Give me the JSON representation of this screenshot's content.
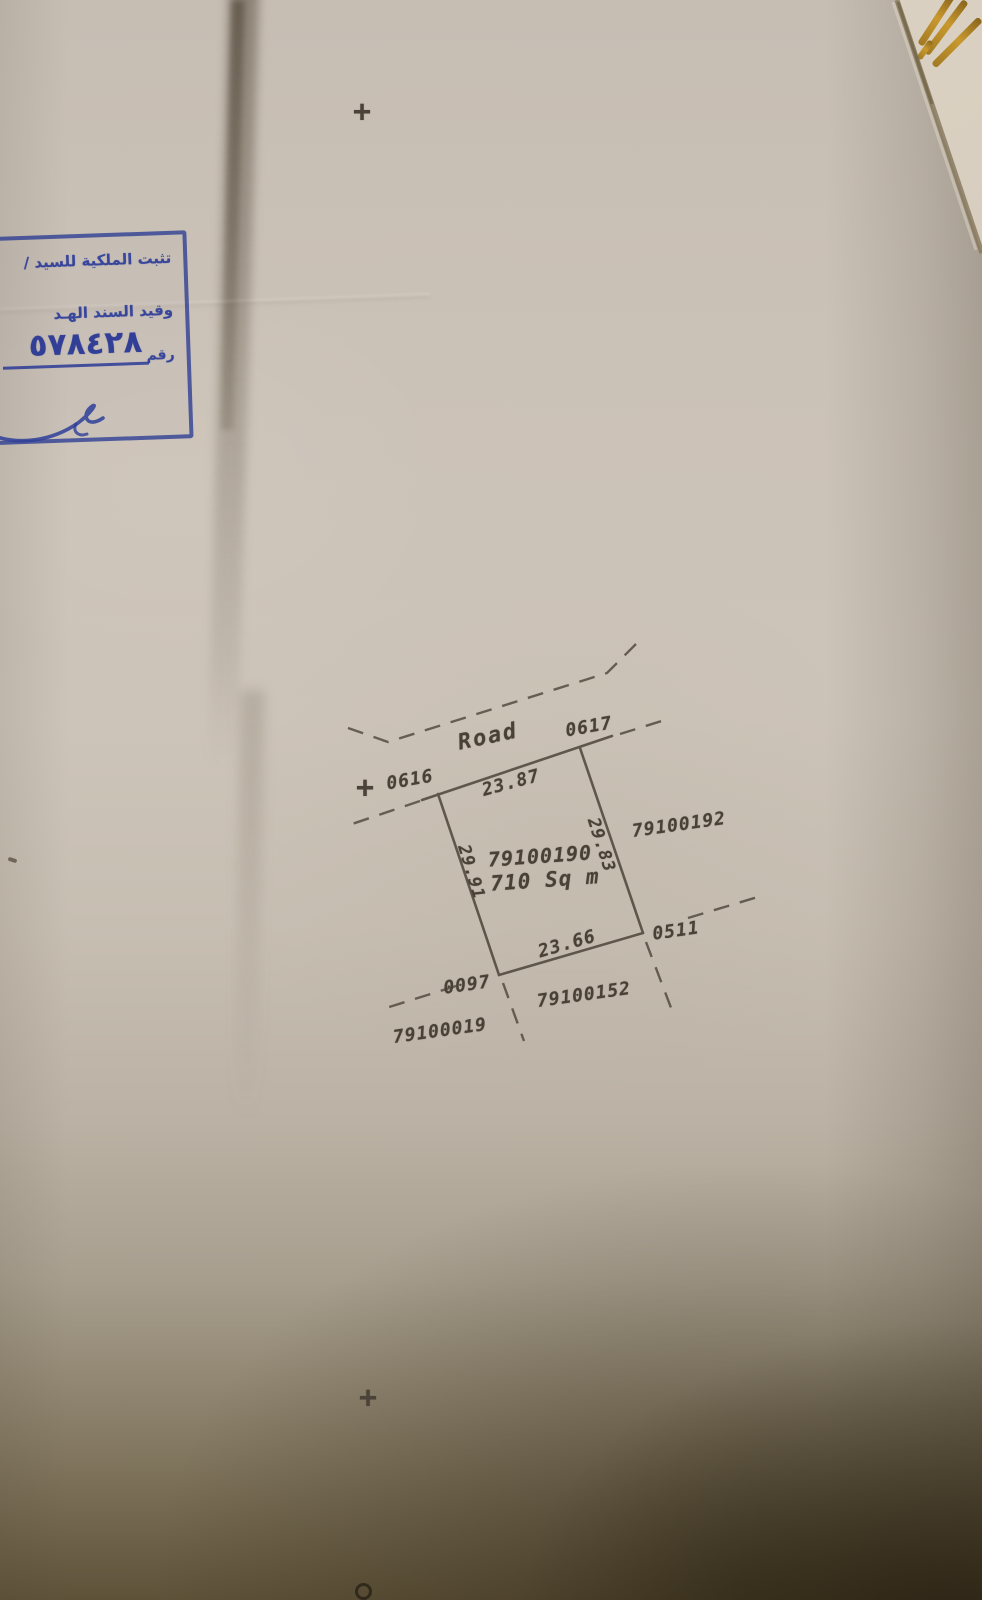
{
  "photo": {
    "description": "Scanned cadastral land-survey sheet photograph"
  },
  "stamp": {
    "line1": "تثبت الملكية للسيد /",
    "line2": "وقيد السند الهـد",
    "number_label": "رقم",
    "number_value": "٥٧٨٤٢٨"
  },
  "diagram": {
    "road_label": "Road",
    "parcel_number": "79100190",
    "parcel_area": "710 Sq m",
    "dimensions": {
      "top": "23.87",
      "bottom": "23.66",
      "left": "29.91",
      "right": "29.83"
    },
    "corners": {
      "top_left": "0616",
      "top_right": "0617",
      "bottom_right": "0511",
      "bottom_left": "0097"
    },
    "neighbors": {
      "right": "79100192",
      "bottom": "79100152",
      "bottom_left": "79100019"
    },
    "survey_cross": "+"
  },
  "colors": {
    "ink": "#4b4339",
    "stamp_blue": "#2e3e99",
    "paper": "#cbc2b7",
    "gold": "#b8882e"
  }
}
